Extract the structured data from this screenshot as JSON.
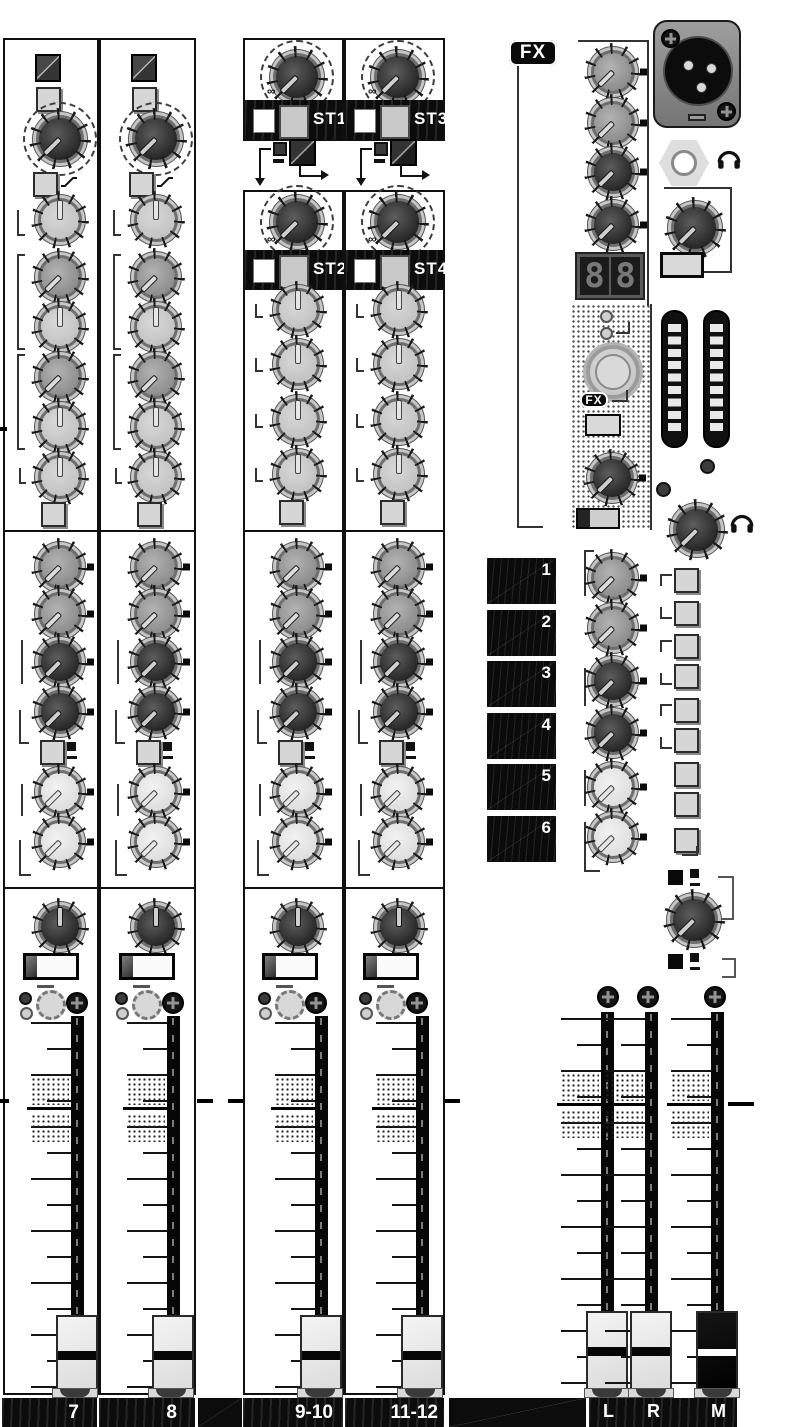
{
  "labels": {
    "ch": [
      "7",
      "8",
      "9-10",
      "11-12"
    ],
    "l": "L",
    "r": "R",
    "m": "M"
  },
  "st": [
    {
      "top": "ST1",
      "mid": "ST2",
      "inf": "∞"
    },
    {
      "top": "ST3",
      "mid": "ST4",
      "inf": "∞"
    }
  ],
  "fx": {
    "logo": "FX",
    "logo_small": "FX",
    "d1": "8",
    "d2": "8"
  },
  "aux": [
    "1",
    "2",
    "3",
    "4",
    "5",
    "6"
  ],
  "icons": {
    "headphones": "headphone arc with two ear cups",
    "low_cut": "rising slope filter glyph",
    "infinity": "∞",
    "arrow_down": "▼",
    "arrow_right": "►"
  }
}
